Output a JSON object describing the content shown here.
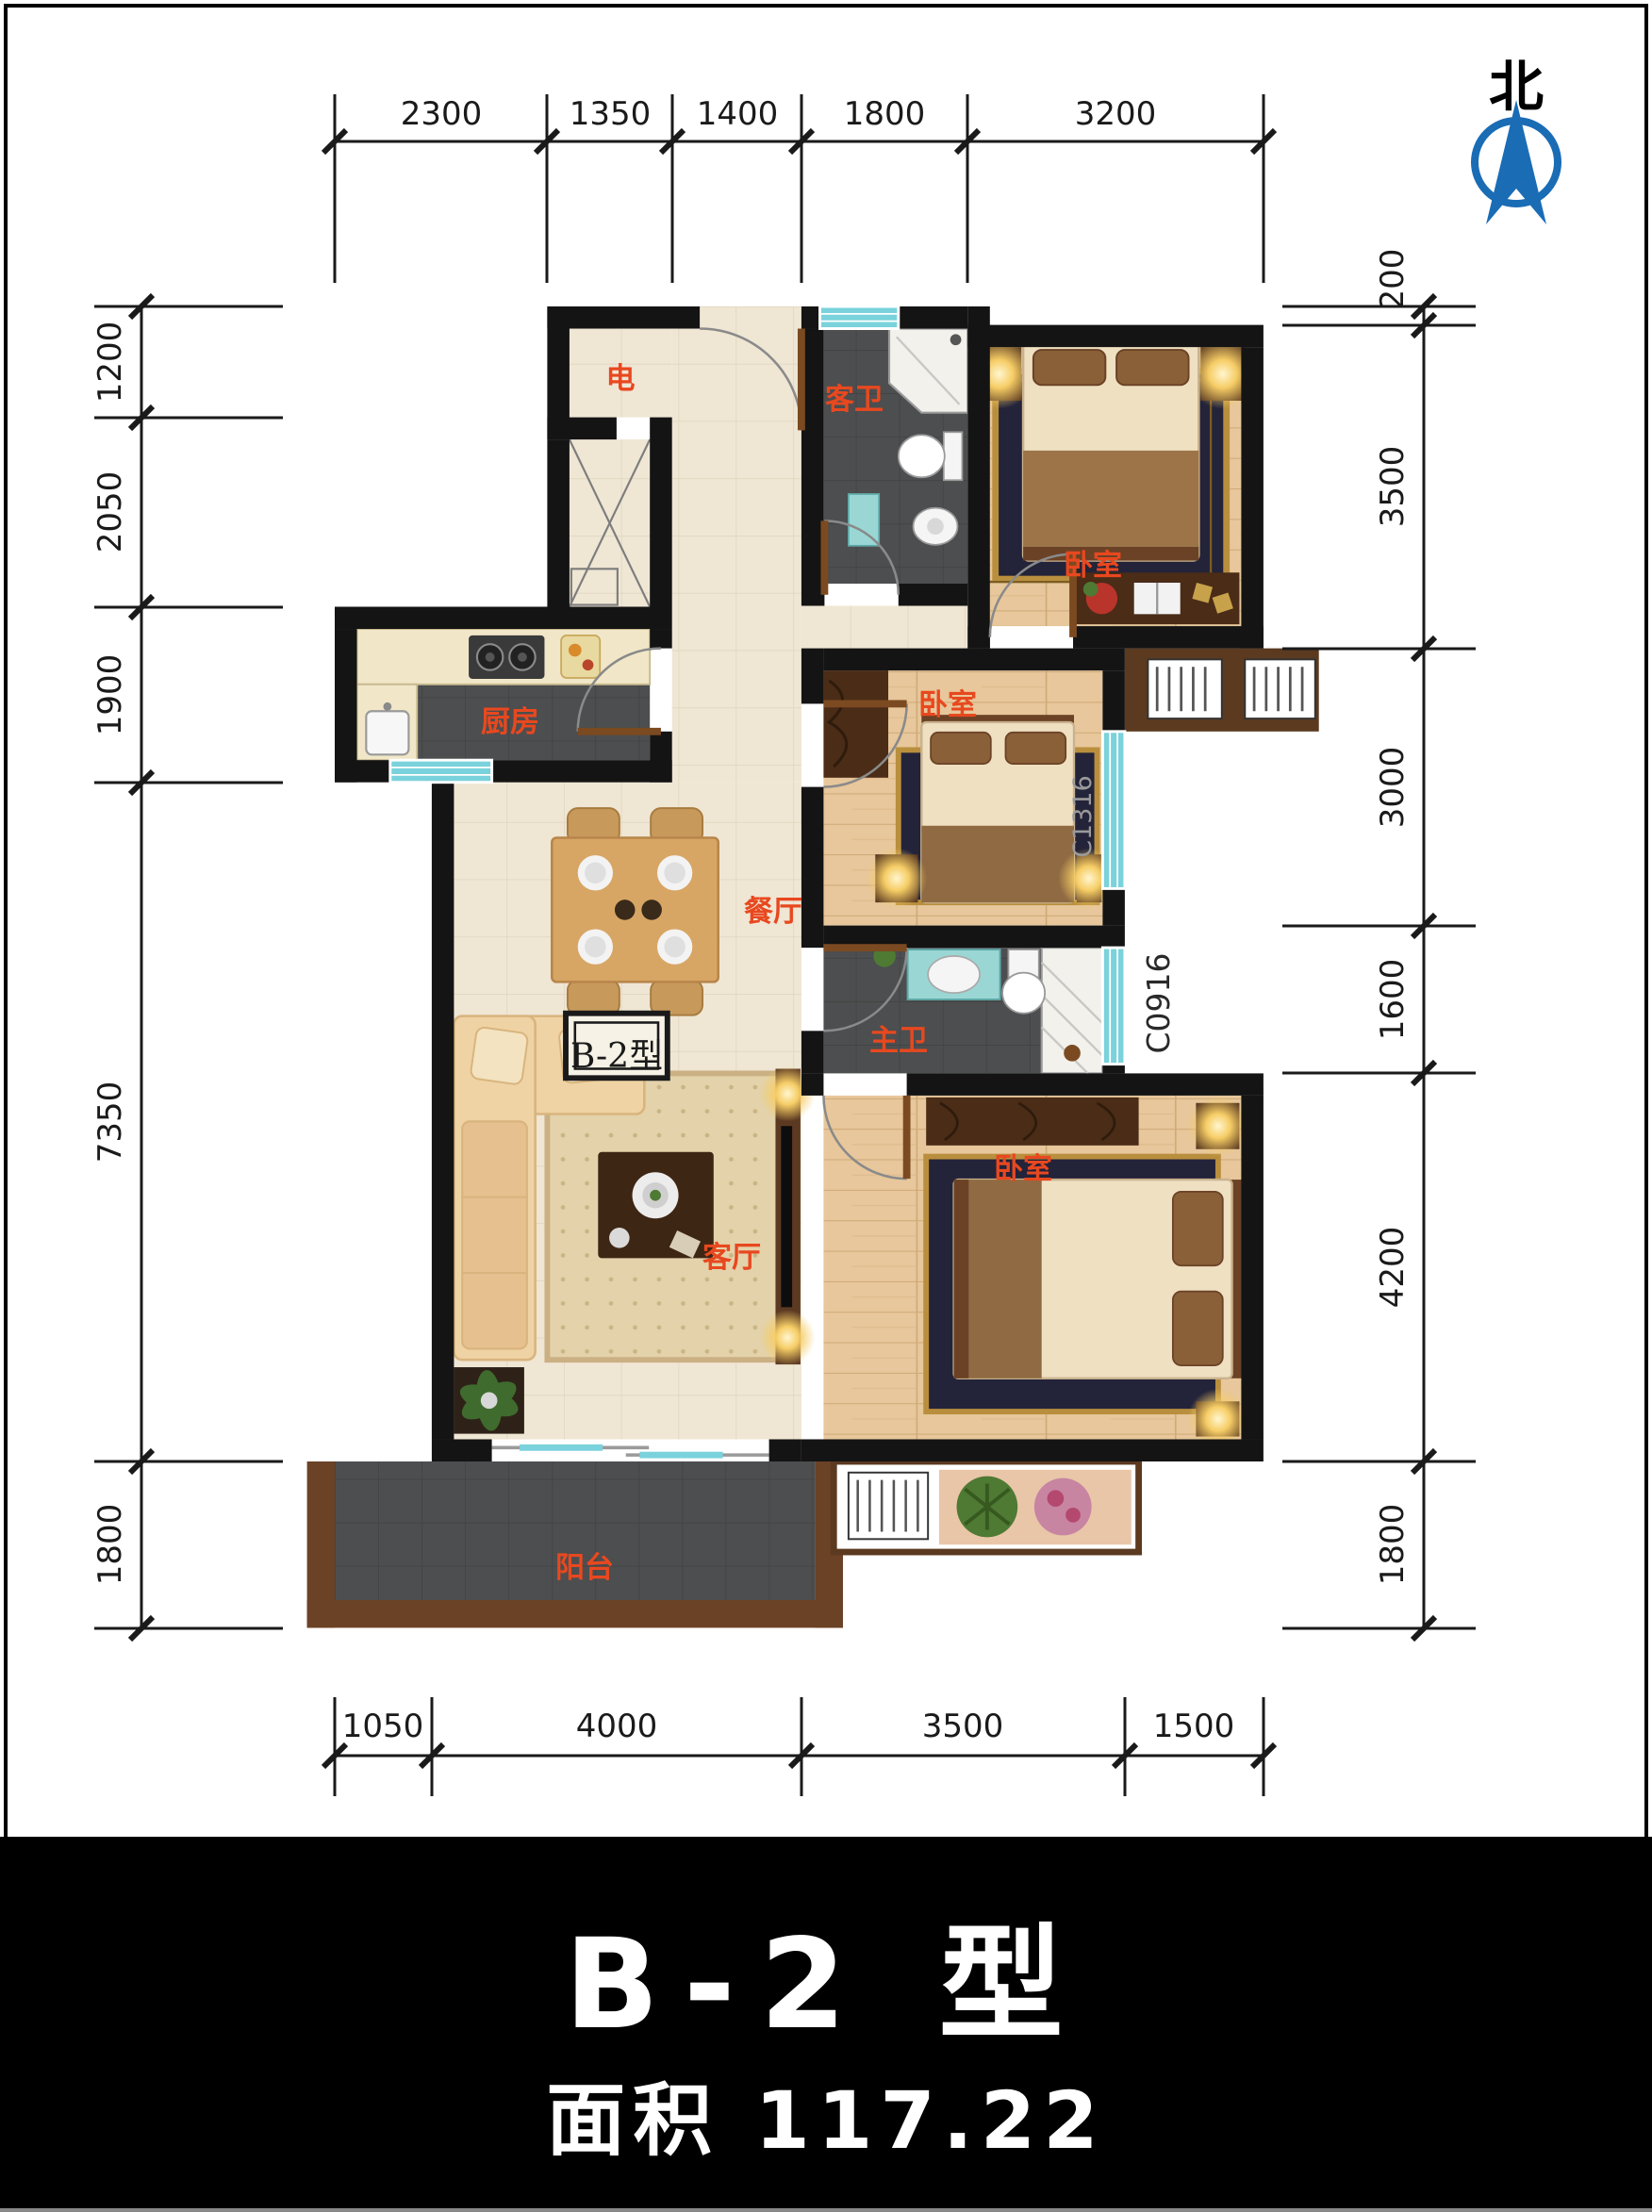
{
  "compass": {
    "label": "北"
  },
  "dimensions": {
    "top": [
      "2300",
      "1350",
      "1400",
      "1800",
      "3200"
    ],
    "bottom": [
      "1050",
      "4000",
      "3500",
      "1500"
    ],
    "left": [
      "1200",
      "2050",
      "1900",
      "7350",
      "1800"
    ],
    "right": [
      "200",
      "3500",
      "3000",
      "1600",
      "4200",
      "1800"
    ]
  },
  "rooms": {
    "electrical": "电",
    "guest_bath": "客卫",
    "bedroom_top": "卧室",
    "bedroom_mid": "卧室",
    "bedroom_bottom": "卧室",
    "kitchen": "厨房",
    "dining": "餐厅",
    "master_bath": "主卫",
    "living": "客厅",
    "balcony": "阳台"
  },
  "plan_tag": "B-2型",
  "window_codes": {
    "mid": "C1316",
    "lower": "C0916"
  },
  "footer": {
    "title": "B-2 型",
    "area": "面积 117.22"
  },
  "colors": {
    "accent_red": "#E8481F",
    "compass_blue": "#1A6CB5",
    "window_cyan": "#7AD2DC"
  }
}
